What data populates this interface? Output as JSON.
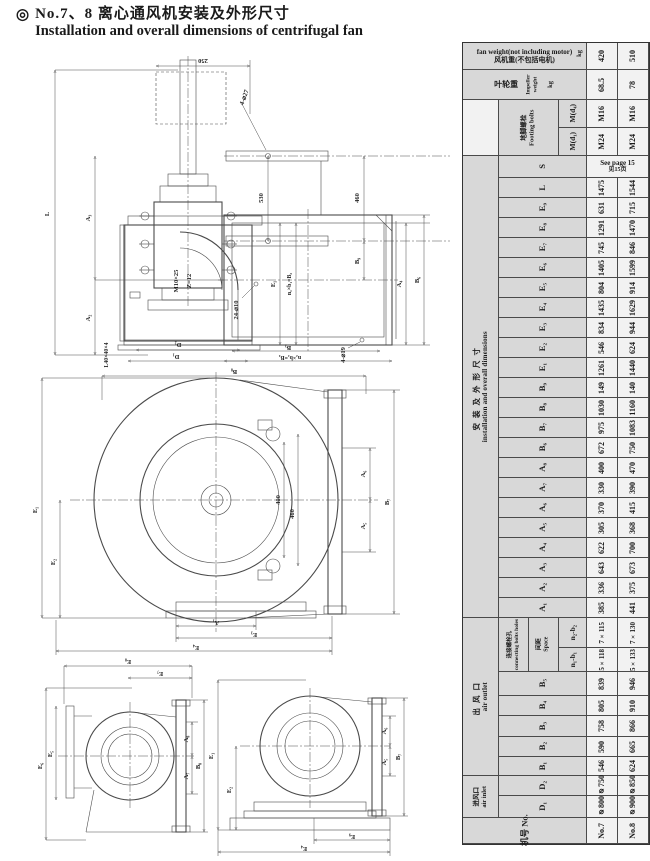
{
  "page": {
    "bullet": "◎",
    "title_zh": "No.7、8 离心通风机安装及外形尺寸",
    "title_en": "Installation and overall dimensions of centrifugal fan"
  },
  "drawings": {
    "v1": {
      "labels": [
        "250",
        "4-⌀27",
        "530",
        "460",
        "B₉",
        "L",
        "A₃",
        "A₂",
        "M10×25",
        "Z=12",
        "L40×40×4",
        "D₂",
        "D₁",
        "24-⌀10",
        "E₁",
        "n₁×b₁=B₂",
        "A₄",
        "B₆",
        "B₃",
        "n₂×b₂=B₄",
        "4-⌀19"
      ]
    },
    "v2": {
      "labels": [
        "B₈",
        "E₁",
        "E₂",
        "400",
        "460",
        "A₆",
        "A₅",
        "B₇",
        "A₁",
        "E₃",
        "E₄"
      ]
    },
    "v3": {
      "labels": [
        "E₈",
        "E₇",
        "E₆",
        "E₅",
        "A₈",
        "A₇",
        "B₈"
      ]
    },
    "v4": {
      "labels": [
        "E₁",
        "E₂",
        "A₆",
        "A₅",
        "B₇",
        "E₉",
        "E₄"
      ]
    }
  },
  "table": {
    "models": [
      "No.7",
      "No.8"
    ],
    "groups": {
      "install_zh": "安装及外形尺寸",
      "install_en": "installation and overall dimensions",
      "outlet_zh": "出风口",
      "outlet_en": "air outlet",
      "inlet_zh": "进风口",
      "inlet_en": "air inlet"
    },
    "rows": [
      {
        "kind": "weight",
        "en": "fan weight(not including motor)",
        "zh": "风机重(不包括电机)",
        "unit": "kg",
        "v7": "420",
        "v8": "510"
      },
      {
        "kind": "weight2",
        "zh": "叶轮重",
        "en1": "Impeller",
        "en2": "weight",
        "unit": "kg",
        "v7": "68.5",
        "v8": "78"
      },
      {
        "kind": "bolt1",
        "grp_zh": "地脚螺栓",
        "grp_en": "Footing bolts",
        "label": "M(d₄)",
        "v7": "M16",
        "v8": "M16"
      },
      {
        "kind": "bolt2",
        "label": "M(d₁)",
        "v7": "M24",
        "v8": "M24"
      },
      {
        "kind": "s",
        "label": "S",
        "en": "See page 15",
        "zh": "见15页"
      },
      {
        "kind": "dim",
        "label": "L",
        "v7": "1475",
        "v8": "1544"
      },
      {
        "kind": "dim",
        "label": "E₉",
        "v7": "631",
        "v8": "715"
      },
      {
        "kind": "dim",
        "label": "E₈",
        "v7": "1291",
        "v8": "1470"
      },
      {
        "kind": "dim",
        "label": "E₇",
        "v7": "745",
        "v8": "846"
      },
      {
        "kind": "dim",
        "label": "E₆",
        "v7": "1405",
        "v8": "1599"
      },
      {
        "kind": "dim",
        "label": "E₅",
        "v7": "804",
        "v8": "914"
      },
      {
        "kind": "dim",
        "label": "E₄",
        "v7": "1435",
        "v8": "1629"
      },
      {
        "kind": "dim",
        "label": "E₃",
        "v7": "834",
        "v8": "944"
      },
      {
        "kind": "dim",
        "label": "E₂",
        "v7": "546",
        "v8": "624"
      },
      {
        "kind": "dim",
        "label": "E₁",
        "v7": "1261",
        "v8": "1440"
      },
      {
        "kind": "dim",
        "label": "B₉",
        "v7": "149",
        "v8": "140"
      },
      {
        "kind": "dim",
        "label": "B₈",
        "v7": "1030",
        "v8": "1160"
      },
      {
        "kind": "dim",
        "label": "B₇",
        "v7": "975",
        "v8": "1083"
      },
      {
        "kind": "dim",
        "label": "B₆",
        "v7": "672",
        "v8": "750"
      },
      {
        "kind": "dim",
        "label": "A₈",
        "v7": "400",
        "v8": "470"
      },
      {
        "kind": "dim",
        "label": "A₇",
        "v7": "330",
        "v8": "390"
      },
      {
        "kind": "dim",
        "label": "A₆",
        "v7": "370",
        "v8": "415"
      },
      {
        "kind": "dim",
        "label": "A₅",
        "v7": "305",
        "v8": "368"
      },
      {
        "kind": "dim",
        "label": "A₄",
        "v7": "622",
        "v8": "700"
      },
      {
        "kind": "dim",
        "label": "A₃",
        "v7": "643",
        "v8": "673"
      },
      {
        "kind": "dim",
        "label": "A₂",
        "v7": "336",
        "v8": "375"
      },
      {
        "kind": "dim",
        "label": "A₁",
        "v7": "385",
        "v8": "441"
      },
      {
        "kind": "conn1",
        "grpA_zh": "连接螺栓孔",
        "grpA_en": "connecting bolts holes",
        "grpB_zh": "间距",
        "grpB_en": "Space",
        "label": "n₂-b₂",
        "v7": "7×115",
        "v8": "7×130"
      },
      {
        "kind": "conn2",
        "label": "n₁-b₁",
        "v7": "5×118",
        "v8": "5×133"
      },
      {
        "kind": "dim",
        "label": "B₅",
        "v7": "839",
        "v8": "946"
      },
      {
        "kind": "dim",
        "label": "B₄",
        "v7": "805",
        "v8": "910"
      },
      {
        "kind": "dim",
        "label": "B₃",
        "v7": "758",
        "v8": "866"
      },
      {
        "kind": "dim",
        "label": "B₂",
        "v7": "590",
        "v8": "665"
      },
      {
        "kind": "dim",
        "label": "B₁",
        "v7": "546",
        "v8": "624"
      },
      {
        "kind": "dim",
        "label": "D₂",
        "v7": "⌀750",
        "v8": "⌀850"
      },
      {
        "kind": "dim",
        "label": "D₁",
        "v7": "⌀800",
        "v8": "⌀900"
      },
      {
        "kind": "model",
        "zh": "机号",
        "en": "No.",
        "v7": "No.7",
        "v8": "No.8"
      }
    ]
  }
}
